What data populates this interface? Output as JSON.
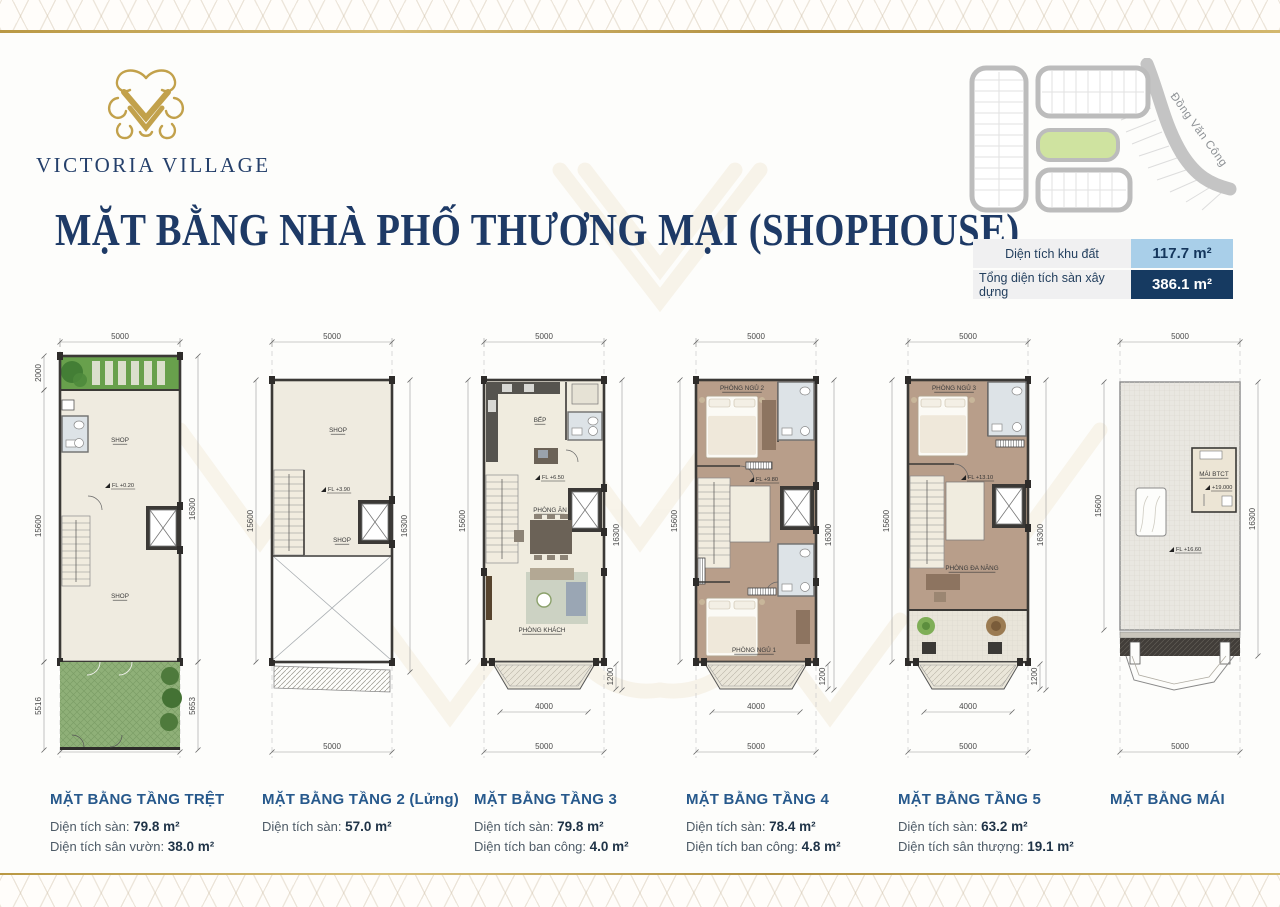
{
  "brand": {
    "name": "VICTORIA VILLAGE"
  },
  "page_title": "MẶT BẰNG NHÀ PHỐ THƯƠNG MẠI (SHOPHOUSE)",
  "sitemap": {
    "street_label": "Đồng Văn Công"
  },
  "summary": {
    "rows": [
      {
        "label": "Diện tích khu đất",
        "value": "117.7 m²",
        "style": "light"
      },
      {
        "label": "Tổng diện tích sàn xây dựng",
        "value": "386.1 m²",
        "style": "dark"
      }
    ]
  },
  "colors": {
    "navy": "#1e3a66",
    "heading_blue": "#27598c",
    "gold": "#c2a14b",
    "value_light_bg": "#a9cfe9",
    "value_dark_bg": "#163a61"
  },
  "plans": [
    {
      "id": "ground",
      "caption": "MẶT BẰNG TẦNG TRỆT",
      "details": [
        {
          "label": "Diện tích sàn:",
          "value": "79.8 m²"
        },
        {
          "label": "Diện tích sân vườn:",
          "value": "38.0 m²"
        }
      ],
      "dims": {
        "top": "5000",
        "bottom": "5000",
        "left": [
          "2000",
          "15600",
          "5516"
        ],
        "right": [
          "16300",
          "5653"
        ]
      },
      "rooms": [
        "SHOP",
        "SHOP"
      ],
      "level": "FL +0.20"
    },
    {
      "id": "mezzanine",
      "caption": "MẶT BẰNG TẦNG 2 (Lửng)",
      "details": [
        {
          "label": "Diện tích sàn:",
          "value": "57.0 m²"
        }
      ],
      "dims": {
        "top": "5000",
        "bottom": "5000",
        "left": [
          "15600"
        ],
        "right": [
          "16300"
        ]
      },
      "rooms": [
        "SHOP",
        "SHOP"
      ],
      "level": "FL +3.90"
    },
    {
      "id": "floor3",
      "caption": "MẶT BẰNG TẦNG 3",
      "details": [
        {
          "label": "Diện tích sàn:",
          "value": "79.8 m²"
        },
        {
          "label": "Diện tích ban công:",
          "value": "4.0 m²"
        }
      ],
      "dims": {
        "top": "5000",
        "bottom": "5000",
        "left": [
          "15600"
        ],
        "right": [
          "16300"
        ],
        "balcony_w": "4000",
        "balcony_d": "1200"
      },
      "rooms": [
        "BẾP",
        "PHÒNG ĂN",
        "PHÒNG KHÁCH"
      ],
      "level": "FL +6.50"
    },
    {
      "id": "floor4",
      "caption": "MẶT BẰNG TẦNG 4",
      "details": [
        {
          "label": "Diện tích sàn:",
          "value": "78.4 m²"
        },
        {
          "label": "Diện tích ban công:",
          "value": "4.8 m²"
        }
      ],
      "dims": {
        "top": "5000",
        "bottom": "5000",
        "left": [
          "15600"
        ],
        "right": [
          "16300"
        ],
        "balcony_w": "4000",
        "balcony_d": "1200"
      },
      "rooms": [
        "PHÒNG NGỦ 2",
        "PHÒNG NGỦ 1"
      ],
      "level": "FL +9.80"
    },
    {
      "id": "floor5",
      "caption": "MẶT BẰNG TẦNG 5",
      "details": [
        {
          "label": "Diện tích sàn:",
          "value": "63.2 m²"
        },
        {
          "label": "Diện tích sân thượng:",
          "value": "19.1 m²"
        }
      ],
      "dims": {
        "top": "5000",
        "bottom": "5000",
        "left": [
          "15600"
        ],
        "right": [
          "16300"
        ],
        "balcony_w": "4000",
        "balcony_d": "1200"
      },
      "rooms": [
        "PHÒNG NGỦ 3",
        "PHÒNG ĐA NĂNG"
      ],
      "level": "FL +13.10"
    },
    {
      "id": "roof",
      "caption": "MẶT BẰNG MÁI",
      "details": [],
      "dims": {
        "top": "5000",
        "bottom": "5000",
        "left": [
          "15600"
        ],
        "right": [
          "16300"
        ]
      },
      "rooms": [
        "MÁI BTCT",
        "+19.000"
      ],
      "level": "FL +16.60"
    }
  ]
}
